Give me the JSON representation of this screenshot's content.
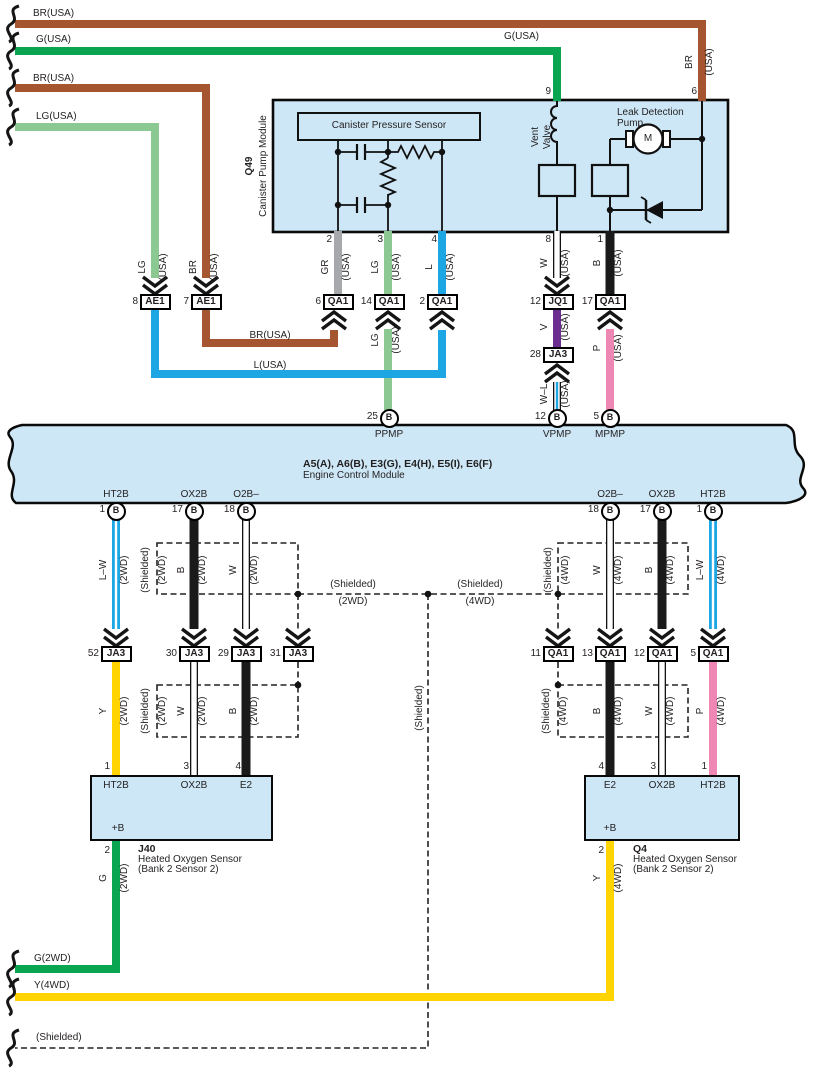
{
  "colors": {
    "module_fill": "#CDE7F6",
    "wire_brown": "#A5552F",
    "wire_green": "#0AA551",
    "wire_light_green": "#8CC891",
    "wire_gray": "#A6A8AB",
    "wire_blue": "#1CA6E4",
    "wire_yellow": "#FFD400",
    "wire_pink": "#EE87B4",
    "wire_violet": "#6C2D91",
    "wire_black": "#1A1A1A",
    "wire_white": "#FFFFFF",
    "outline": "#231F20"
  },
  "codes": {
    "gr": "GR",
    "lg": "LG",
    "l": "L",
    "w": "W",
    "b": "B",
    "v": "V",
    "p": "P",
    "y": "Y",
    "g": "G",
    "br": "BR",
    "lw": "L–W",
    "wl": "W–L",
    "usa": "(USA)",
    "wd2": "(2WD)",
    "wd4": "(4WD)",
    "shielded": "(Shielded)"
  },
  "feeds": {
    "br1": "BR(USA)",
    "g1": "G(USA)",
    "br2": "BR(USA)",
    "lg1": "LG(USA)",
    "g_right": "G(USA)",
    "br_jumper": "BR(USA)",
    "l_jumper": "L(USA)",
    "g_bottom": "G(2WD)",
    "y_bottom": "Y(4WD)",
    "shielded_bottom": "(Shielded)"
  },
  "q49": {
    "code": "Q49",
    "name": "Canister Pump Module",
    "sensor": "Canister Pressure Sensor",
    "vent1": "Vent",
    "vent2": "Valve",
    "pump1": "Leak Detection",
    "pump2": "Pump",
    "motor": "M",
    "pins": {
      "p9": "9",
      "p6": "6",
      "p2": "2",
      "p3": "3",
      "p4": "4",
      "p8": "8",
      "p1": "1"
    }
  },
  "row1": [
    {
      "n": "8",
      "c": "AE1"
    },
    {
      "n": "7",
      "c": "AE1"
    },
    {
      "n": "6",
      "c": "QA1"
    },
    {
      "n": "14",
      "c": "QA1"
    },
    {
      "n": "2",
      "c": "QA1"
    },
    {
      "n": "12",
      "c": "JQ1"
    },
    {
      "n": "17",
      "c": "QA1"
    }
  ],
  "j28": {
    "n": "28",
    "c": "JA3"
  },
  "ecm": {
    "title": "A5(A), A6(B), E3(G), E4(H), E5(I), E6(F)",
    "subtitle": "Engine Control Module",
    "b": "B",
    "top_pins": [
      {
        "n": "25",
        "sig": "PPMP"
      },
      {
        "n": "12",
        "sig": "VPMP"
      },
      {
        "n": "5",
        "sig": "MPMP"
      }
    ],
    "bottom_left": [
      {
        "n": "1",
        "sig": "HT2B"
      },
      {
        "n": "17",
        "sig": "OX2B"
      },
      {
        "n": "18",
        "sig": "O2B–"
      }
    ],
    "bottom_right": [
      {
        "n": "18",
        "sig": "O2B–"
      },
      {
        "n": "17",
        "sig": "OX2B"
      },
      {
        "n": "1",
        "sig": "HT2B"
      }
    ]
  },
  "row2_left": [
    {
      "n": "52",
      "c": "JA3"
    },
    {
      "n": "30",
      "c": "JA3"
    },
    {
      "n": "29",
      "c": "JA3"
    },
    {
      "n": "31",
      "c": "JA3"
    }
  ],
  "row2_right": [
    {
      "n": "11",
      "c": "QA1"
    },
    {
      "n": "13",
      "c": "QA1"
    },
    {
      "n": "12",
      "c": "QA1"
    },
    {
      "n": "5",
      "c": "QA1"
    }
  ],
  "j40": {
    "code": "J40",
    "name1": "Heated Oxygen Sensor",
    "name2": "(Bank 2 Sensor 2)",
    "term_top": [
      "HT2B",
      "OX2B",
      "E2"
    ],
    "term_bottom": "+B",
    "pins_top": [
      "1",
      "3",
      "4"
    ],
    "pin_bottom": "2"
  },
  "q4": {
    "code": "Q4",
    "name1": "Heated Oxygen Sensor",
    "name2": "(Bank 2 Sensor 2)",
    "term_top": [
      "E2",
      "OX2B",
      "HT2B"
    ],
    "term_bottom": "+B",
    "pins_top": [
      "4",
      "3",
      "1"
    ],
    "pin_bottom": "2"
  }
}
